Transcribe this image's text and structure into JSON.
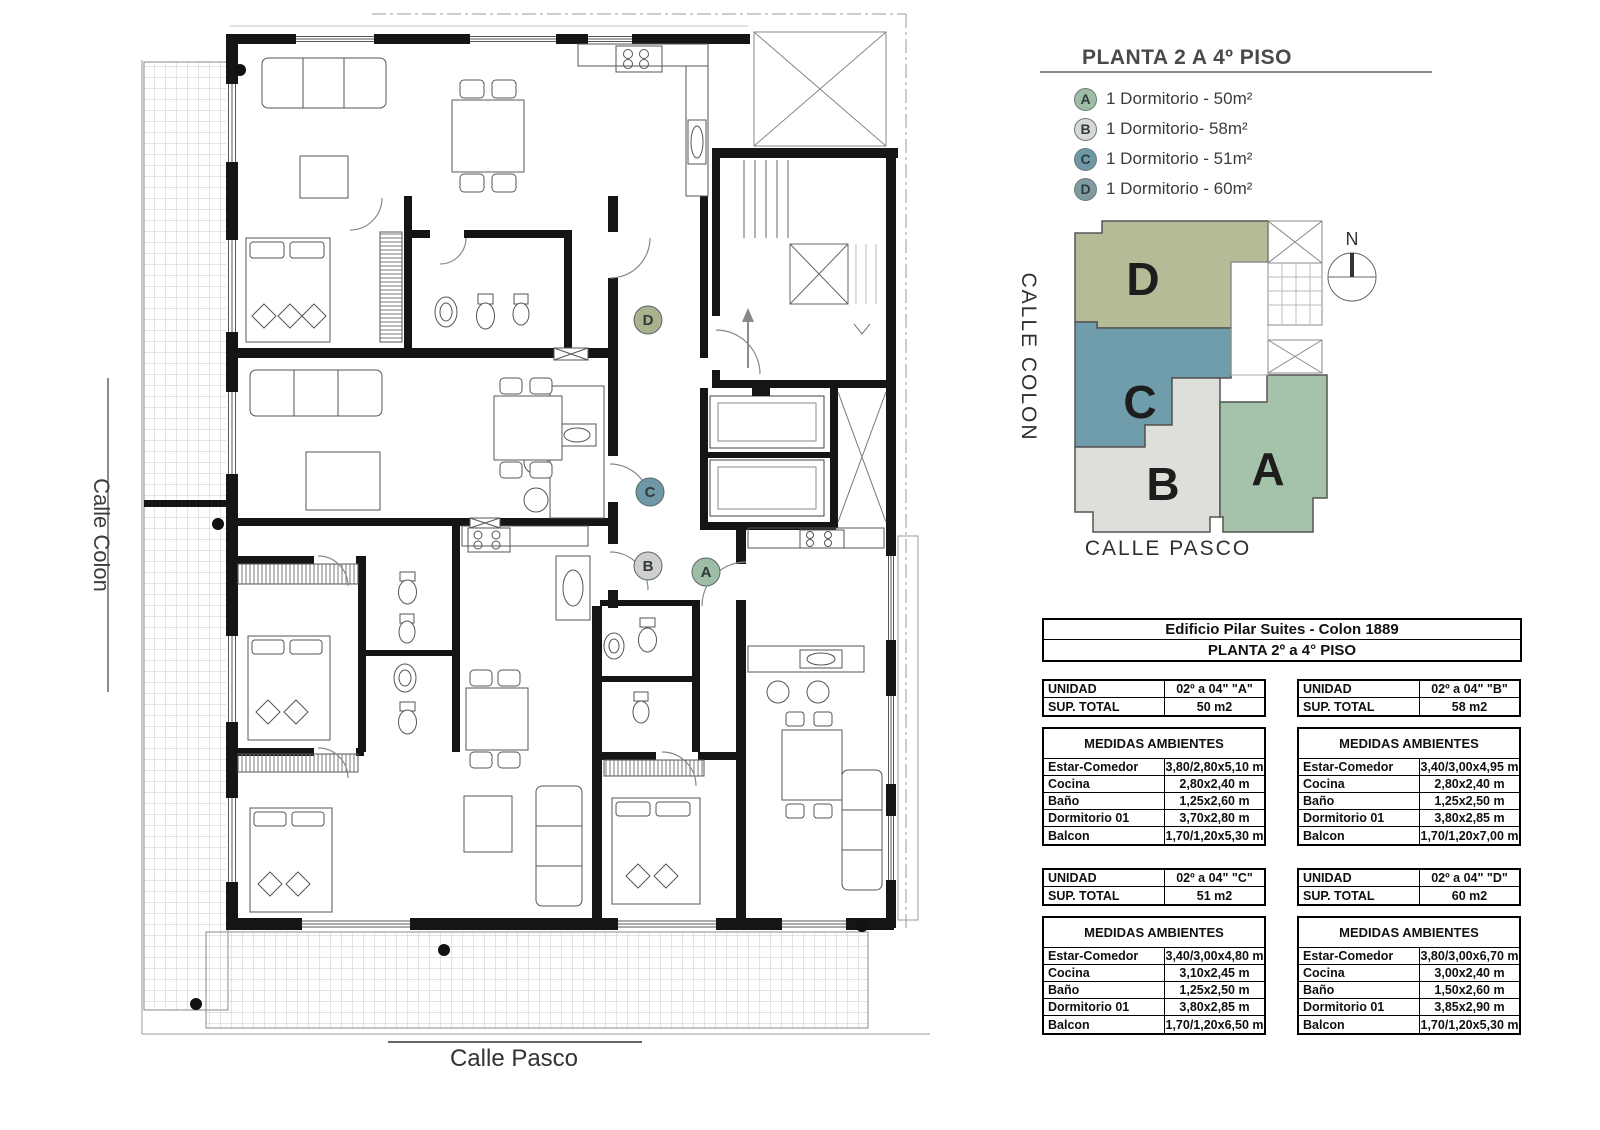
{
  "title": "PLANTA 2 A 4º PISO",
  "legend": {
    "items": [
      {
        "letter": "A",
        "label": "1 Dormitorio - 50m²",
        "color": "#9dbda4"
      },
      {
        "letter": "B",
        "label": "1 Dormitorio- 58m²",
        "color": "#d8d8d6"
      },
      {
        "letter": "C",
        "label": "1 Dormitorio - 51m²",
        "color": "#6e98a5"
      },
      {
        "letter": "D",
        "label": "1 Dormitorio - 60m²",
        "color": "#7f9aa0"
      }
    ]
  },
  "plan": {
    "street_left": "Calle Colon",
    "street_bottom": "Calle Pasco",
    "unit_markers": [
      {
        "letter": "D",
        "color": "#a9b28c"
      },
      {
        "letter": "C",
        "color": "#6e98a5"
      },
      {
        "letter": "B",
        "color": "#cfcfcd"
      },
      {
        "letter": "A",
        "color": "#9dbda4"
      }
    ]
  },
  "key_plan": {
    "street_left": "CALLE COLON",
    "street_bottom": "CALLE PASCO",
    "north_label": "N",
    "units": [
      {
        "letter": "A",
        "color": "#a5c3aa"
      },
      {
        "letter": "B",
        "color": "#dededa"
      },
      {
        "letter": "C",
        "color": "#6f9dab"
      },
      {
        "letter": "D",
        "color": "#b6ba96"
      }
    ]
  },
  "building_header": {
    "line1": "Edificio Pilar Suites - Colon 1889",
    "line2": "PLANTA 2º a 4° PISO"
  },
  "unit_tables": [
    {
      "unidad_label": "UNIDAD",
      "unidad_value": "02º a 04\" \"A\"",
      "sup_label": "SUP. TOTAL",
      "sup_value": "50 m2",
      "medidas_title": "MEDIDAS AMBIENTES",
      "rows": [
        [
          "Estar-Comedor",
          "3,80/2,80x5,10 m"
        ],
        [
          "Cocina",
          "2,80x2,40 m"
        ],
        [
          "Baño",
          "1,25x2,60 m"
        ],
        [
          "Dormitorio 01",
          "3,70x2,80 m"
        ],
        [
          "Balcon",
          "1,70/1,20x5,30 m"
        ]
      ]
    },
    {
      "unidad_label": "UNIDAD",
      "unidad_value": "02º a 04\" \"B\"",
      "sup_label": "SUP. TOTAL",
      "sup_value": "58 m2",
      "medidas_title": "MEDIDAS AMBIENTES",
      "rows": [
        [
          "Estar-Comedor",
          "3,40/3,00x4,95 m"
        ],
        [
          "Cocina",
          "2,80x2,40 m"
        ],
        [
          "Baño",
          "1,25x2,50 m"
        ],
        [
          "Dormitorio 01",
          "3,80x2,85 m"
        ],
        [
          "Balcon",
          "1,70/1,20x7,00 m"
        ]
      ]
    },
    {
      "unidad_label": "UNIDAD",
      "unidad_value": "02º a 04\" \"C\"",
      "sup_label": "SUP. TOTAL",
      "sup_value": "51 m2",
      "medidas_title": "MEDIDAS AMBIENTES",
      "rows": [
        [
          "Estar-Comedor",
          "3,40/3,00x4,80 m"
        ],
        [
          "Cocina",
          "3,10x2,45 m"
        ],
        [
          "Baño",
          "1,25x2,50 m"
        ],
        [
          "Dormitorio 01",
          "3,80x2,85 m"
        ],
        [
          "Balcon",
          "1,70/1,20x6,50 m"
        ]
      ]
    },
    {
      "unidad_label": "UNIDAD",
      "unidad_value": "02º a 04\" \"D\"",
      "sup_label": "SUP. TOTAL",
      "sup_value": "60 m2",
      "medidas_title": "MEDIDAS AMBIENTES",
      "rows": [
        [
          "Estar-Comedor",
          "3,80/3,00x6,70 m"
        ],
        [
          "Cocina",
          "3,00x2,40 m"
        ],
        [
          "Baño",
          "1,50x2,60 m"
        ],
        [
          "Dormitorio 01",
          "3,85x2,90 m"
        ],
        [
          "Balcon",
          "1,70/1,20x5,30 m"
        ]
      ]
    }
  ]
}
